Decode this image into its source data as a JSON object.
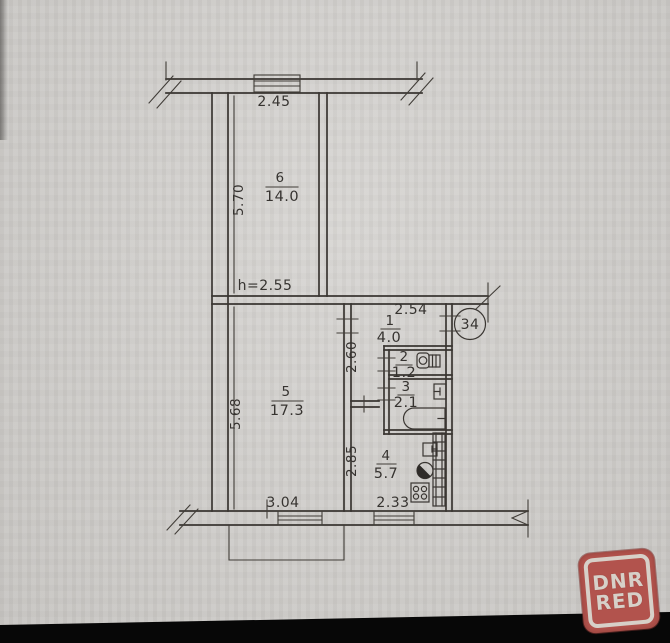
{
  "plan": {
    "apartment_badge": "34",
    "ceiling_height_label": "h=2.55",
    "rooms": [
      {
        "number": "1",
        "area": "4.0"
      },
      {
        "number": "2",
        "area": "1.2"
      },
      {
        "number": "3",
        "area": "2.1"
      },
      {
        "number": "4",
        "area": "5.7"
      },
      {
        "number": "5",
        "area": "17.3"
      },
      {
        "number": "6",
        "area": "14.0"
      }
    ],
    "dimensions": {
      "room6_width": "2.45",
      "room6_depth": "5.70",
      "hall_width": "2.54",
      "hall_depth": "2.60",
      "room5_depth": "5.68",
      "room5_width": "3.04",
      "kitchen_depth": "2.85",
      "kitchen_window_width": "2.33"
    }
  },
  "watermark": {
    "line1": "DNR",
    "line2": "RED",
    "background_color": "#b2534d",
    "text_color": "#d7d0c8"
  },
  "photo": {
    "paper_color": "#d3d1ce",
    "line_color": "#3a3632",
    "bottom_edge_color": "#070707"
  }
}
